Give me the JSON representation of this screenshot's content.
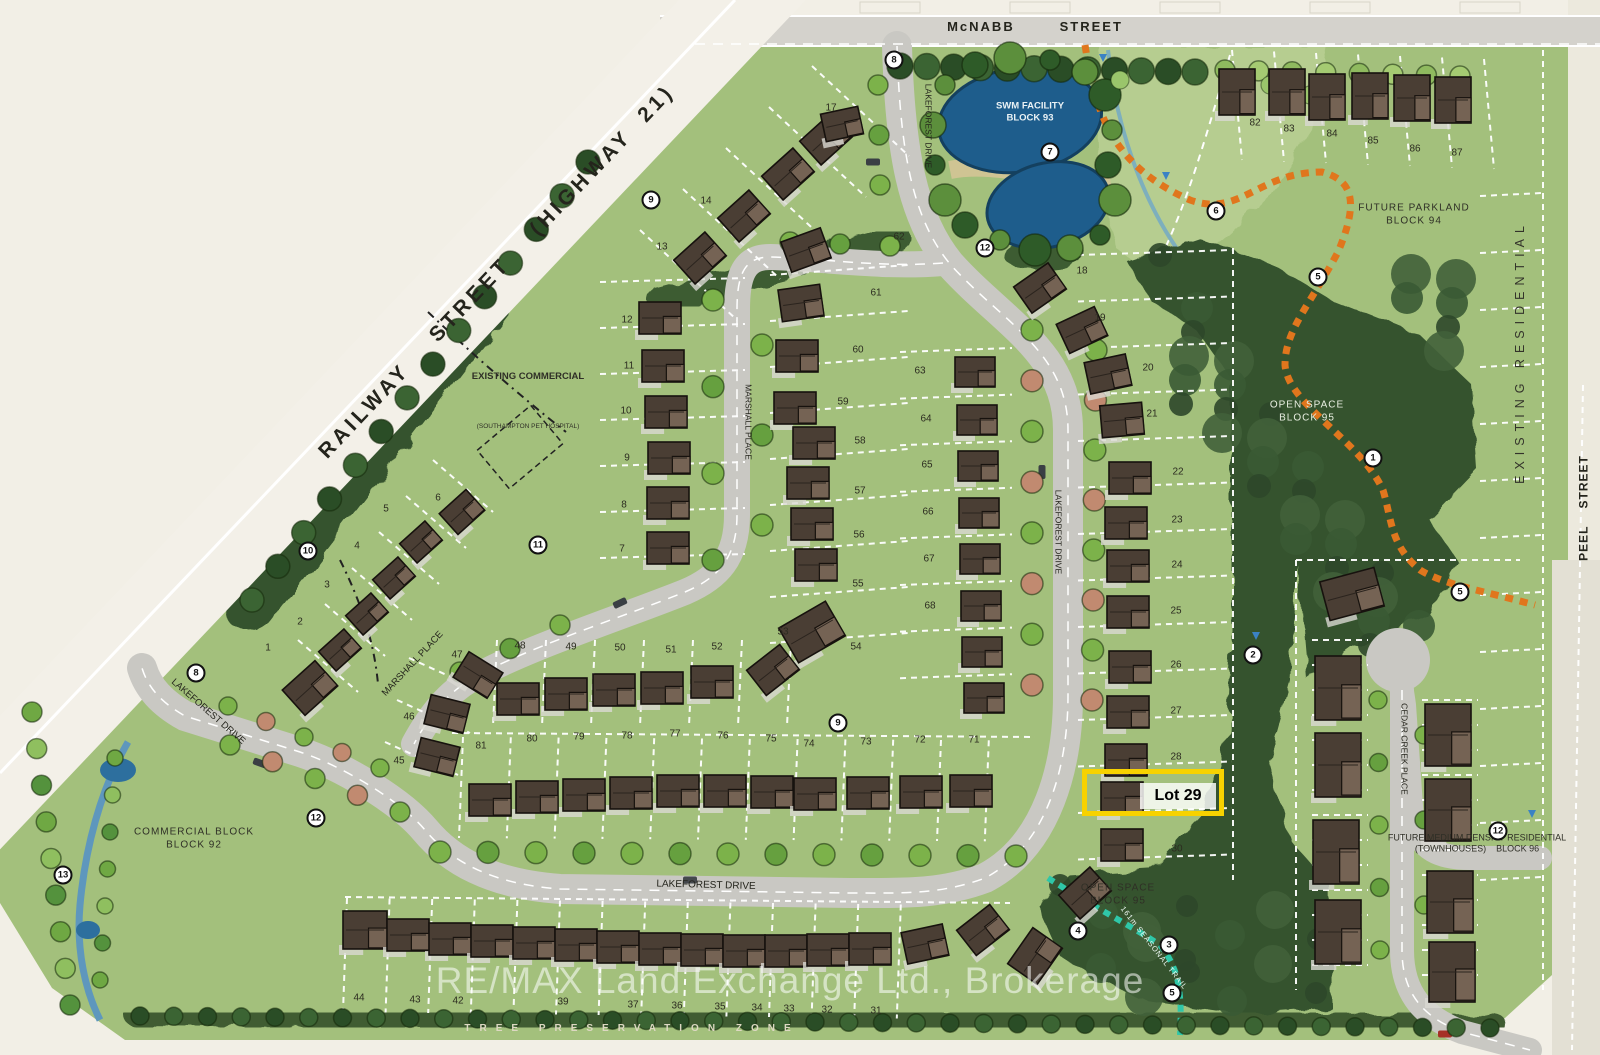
{
  "streets": {
    "mcnabb": "McNABB        STREET",
    "railway": "RAILWAY    STREET    (HIGHWAY  21)",
    "peel": "PEEL    STREET",
    "lakeforest_drive": "LAKEFOREST DRIVE",
    "marshall_place": "MARSHALL PLACE",
    "cedar_creek_place": "CEDAR CREEK PLACE"
  },
  "areas": {
    "swm_facility": {
      "line1": "SWM FACILITY",
      "line2": "BLOCK 93"
    },
    "future_parkland": {
      "line1": "FUTURE PARKLAND",
      "line2": "BLOCK 94"
    },
    "open_space_upper": {
      "line1": "OPEN SPACE",
      "line2": "BLOCK 95"
    },
    "open_space_lower": {
      "line1": "OPEN SPACE",
      "line2": "BLOCK 95"
    },
    "commercial_block": {
      "line1": "COMMERCIAL BLOCK",
      "line2": "BLOCK 92"
    },
    "medium_density": {
      "line1": "FUTURE MEDIUM DENSITY RESIDENTIAL",
      "line2": "(TOWNHOUSES)    BLOCK 96"
    },
    "existing_commercial": {
      "line1": "EXISTING COMMERCIAL",
      "line2": "(SOUTHAMPTON PET HOSPITAL)"
    },
    "existing_residential": "EXISTING RESIDENTIAL",
    "tree_preservation_zone": "TREE PRESERVATION ZONE",
    "seasonal_trail": "161m SEASONAL TRAIL"
  },
  "highlight": {
    "label": "Lot 29"
  },
  "watermark": "RE/MAX Land Exchange Ltd., Brokerage",
  "colors": {
    "highlight_yellow": "#f7d200",
    "pond_blue": "#1e5d8c",
    "trail_orange": "#e0761d",
    "trail_teal": "#2fc7a8",
    "site_green": "#a3c07c",
    "forest_green": "#35522f"
  },
  "lot_numbers": [
    {
      "n": "1",
      "x": 268,
      "y": 648
    },
    {
      "n": "2",
      "x": 300,
      "y": 622
    },
    {
      "n": "3",
      "x": 327,
      "y": 585
    },
    {
      "n": "4",
      "x": 357,
      "y": 546
    },
    {
      "n": "5",
      "x": 386,
      "y": 509
    },
    {
      "n": "6",
      "x": 438,
      "y": 498
    },
    {
      "n": "7",
      "x": 622,
      "y": 549
    },
    {
      "n": "8",
      "x": 624,
      "y": 505
    },
    {
      "n": "9",
      "x": 627,
      "y": 458
    },
    {
      "n": "10",
      "x": 626,
      "y": 411
    },
    {
      "n": "11",
      "x": 629,
      "y": 366
    },
    {
      "n": "12",
      "x": 627,
      "y": 320
    },
    {
      "n": "13",
      "x": 662,
      "y": 247
    },
    {
      "n": "14",
      "x": 706,
      "y": 201
    },
    {
      "n": "17",
      "x": 831,
      "y": 108
    },
    {
      "n": "18",
      "x": 1082,
      "y": 271
    },
    {
      "n": "19",
      "x": 1100,
      "y": 318
    },
    {
      "n": "20",
      "x": 1148,
      "y": 368
    },
    {
      "n": "21",
      "x": 1152,
      "y": 414
    },
    {
      "n": "22",
      "x": 1178,
      "y": 472
    },
    {
      "n": "23",
      "x": 1177,
      "y": 520
    },
    {
      "n": "24",
      "x": 1177,
      "y": 565
    },
    {
      "n": "25",
      "x": 1176,
      "y": 611
    },
    {
      "n": "26",
      "x": 1176,
      "y": 665
    },
    {
      "n": "27",
      "x": 1176,
      "y": 711
    },
    {
      "n": "28",
      "x": 1176,
      "y": 757
    },
    {
      "n": "30",
      "x": 1177,
      "y": 849
    },
    {
      "n": "31",
      "x": 876,
      "y": 1011
    },
    {
      "n": "32",
      "x": 827,
      "y": 1010
    },
    {
      "n": "33",
      "x": 789,
      "y": 1009
    },
    {
      "n": "34",
      "x": 757,
      "y": 1008
    },
    {
      "n": "35",
      "x": 720,
      "y": 1007
    },
    {
      "n": "36",
      "x": 677,
      "y": 1006
    },
    {
      "n": "37",
      "x": 633,
      "y": 1005
    },
    {
      "n": "39",
      "x": 563,
      "y": 1002
    },
    {
      "n": "42",
      "x": 458,
      "y": 1001
    },
    {
      "n": "43",
      "x": 415,
      "y": 1000
    },
    {
      "n": "44",
      "x": 359,
      "y": 998
    },
    {
      "n": "45",
      "x": 399,
      "y": 761
    },
    {
      "n": "46",
      "x": 409,
      "y": 717
    },
    {
      "n": "47",
      "x": 457,
      "y": 655
    },
    {
      "n": "48",
      "x": 520,
      "y": 646
    },
    {
      "n": "49",
      "x": 571,
      "y": 647
    },
    {
      "n": "50",
      "x": 620,
      "y": 648
    },
    {
      "n": "51",
      "x": 671,
      "y": 650
    },
    {
      "n": "52",
      "x": 717,
      "y": 647
    },
    {
      "n": "53",
      "x": 783,
      "y": 632
    },
    {
      "n": "54",
      "x": 856,
      "y": 647
    },
    {
      "n": "55",
      "x": 858,
      "y": 584
    },
    {
      "n": "56",
      "x": 859,
      "y": 535
    },
    {
      "n": "57",
      "x": 860,
      "y": 491
    },
    {
      "n": "58",
      "x": 860,
      "y": 441
    },
    {
      "n": "59",
      "x": 843,
      "y": 402
    },
    {
      "n": "60",
      "x": 858,
      "y": 350
    },
    {
      "n": "61",
      "x": 876,
      "y": 293
    },
    {
      "n": "62",
      "x": 899,
      "y": 237
    },
    {
      "n": "63",
      "x": 920,
      "y": 371
    },
    {
      "n": "64",
      "x": 926,
      "y": 419
    },
    {
      "n": "65",
      "x": 927,
      "y": 465
    },
    {
      "n": "66",
      "x": 928,
      "y": 512
    },
    {
      "n": "67",
      "x": 929,
      "y": 559
    },
    {
      "n": "68",
      "x": 930,
      "y": 606
    },
    {
      "n": "71",
      "x": 974,
      "y": 740
    },
    {
      "n": "72",
      "x": 920,
      "y": 740
    },
    {
      "n": "73",
      "x": 866,
      "y": 742
    },
    {
      "n": "74",
      "x": 809,
      "y": 744
    },
    {
      "n": "75",
      "x": 771,
      "y": 739
    },
    {
      "n": "76",
      "x": 723,
      "y": 736
    },
    {
      "n": "77",
      "x": 675,
      "y": 734
    },
    {
      "n": "78",
      "x": 627,
      "y": 736
    },
    {
      "n": "79",
      "x": 579,
      "y": 737
    },
    {
      "n": "80",
      "x": 532,
      "y": 739
    },
    {
      "n": "81",
      "x": 481,
      "y": 746
    },
    {
      "n": "82",
      "x": 1255,
      "y": 123
    },
    {
      "n": "83",
      "x": 1289,
      "y": 129
    },
    {
      "n": "84",
      "x": 1332,
      "y": 134
    },
    {
      "n": "85",
      "x": 1373,
      "y": 141
    },
    {
      "n": "86",
      "x": 1415,
      "y": 149
    },
    {
      "n": "87",
      "x": 1457,
      "y": 153
    }
  ],
  "legend_markers": [
    {
      "n": "8",
      "x": 894,
      "y": 60
    },
    {
      "n": "9",
      "x": 651,
      "y": 200
    },
    {
      "n": "7",
      "x": 1050,
      "y": 152
    },
    {
      "n": "12",
      "x": 985,
      "y": 248
    },
    {
      "n": "6",
      "x": 1216,
      "y": 211
    },
    {
      "n": "5",
      "x": 1318,
      "y": 277
    },
    {
      "n": "1",
      "x": 1373,
      "y": 458
    },
    {
      "n": "5",
      "x": 1460,
      "y": 592
    },
    {
      "n": "2",
      "x": 1253,
      "y": 655
    },
    {
      "n": "10",
      "x": 308,
      "y": 551
    },
    {
      "n": "11",
      "x": 538,
      "y": 545
    },
    {
      "n": "8",
      "x": 196,
      "y": 673
    },
    {
      "n": "9",
      "x": 838,
      "y": 723
    },
    {
      "n": "12",
      "x": 316,
      "y": 818
    },
    {
      "n": "13",
      "x": 63,
      "y": 875
    },
    {
      "n": "4",
      "x": 1078,
      "y": 931
    },
    {
      "n": "3",
      "x": 1169,
      "y": 945
    },
    {
      "n": "5",
      "x": 1172,
      "y": 993
    },
    {
      "n": "12",
      "x": 1498,
      "y": 831
    }
  ]
}
